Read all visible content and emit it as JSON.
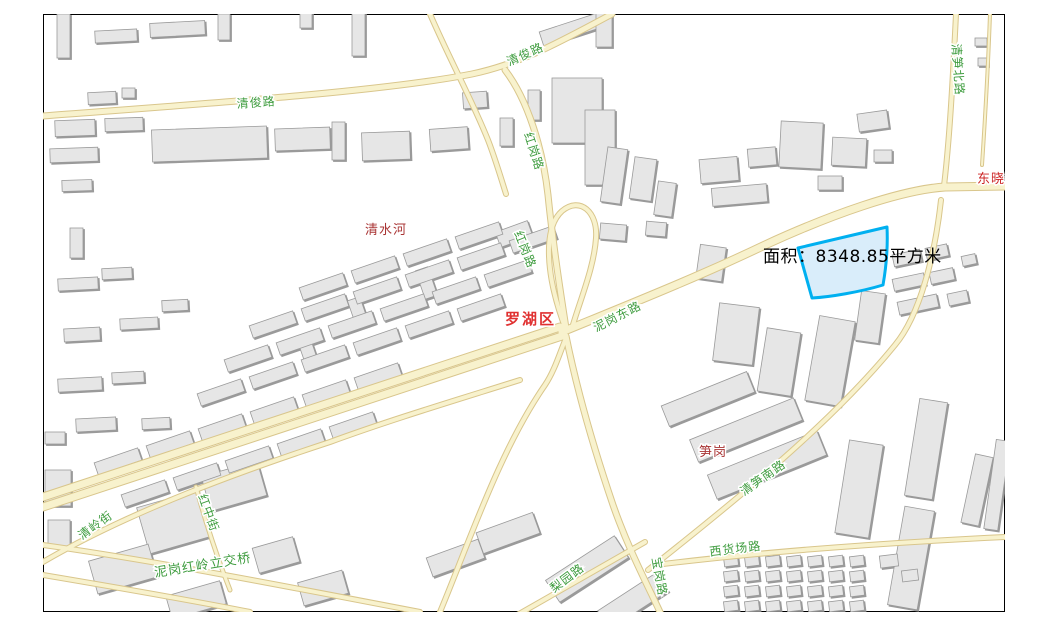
{
  "map": {
    "type": "gis-street-map",
    "frame": {
      "x": 43,
      "y": 14,
      "width": 962,
      "height": 598,
      "border_color": "#000000",
      "background": "#ffffff"
    },
    "measurement": {
      "area_label": "面积：8348.85平方米",
      "prefix": "面积",
      "area_value": "8348.85",
      "area_unit": "平方米"
    },
    "district_labels": [
      {
        "text": "罗湖区"
      }
    ],
    "place_labels": [
      {
        "text": "清水河"
      },
      {
        "text": "笋岗"
      },
      {
        "text": "东晓"
      }
    ],
    "road_labels": [
      {
        "text": "清俊路"
      },
      {
        "text": "清俊路"
      },
      {
        "text": "红岗路"
      },
      {
        "text": "红岗路"
      },
      {
        "text": "泥岗东路"
      },
      {
        "text": "清笋北路"
      },
      {
        "text": "清笋南路"
      },
      {
        "text": "西货场路"
      },
      {
        "text": "梨园路"
      },
      {
        "text": "宝岗路"
      },
      {
        "text": "泥岗红岭立交桥"
      },
      {
        "text": "清岭街"
      },
      {
        "text": "红中街"
      }
    ],
    "colors": {
      "road_label": "#3e9c3e",
      "place_label": "#a93434",
      "district_label": "#e03131",
      "highlight_stroke": "#00b0f0",
      "highlight_fill": "#cfe8f9",
      "road_fill": "#f8f2cd",
      "road_casing": "#d9c68c",
      "building_fill": "#e6e6e6",
      "building_stroke": "#9a9a9a",
      "frame_border": "#000000",
      "map_background": "#ffffff"
    }
  }
}
